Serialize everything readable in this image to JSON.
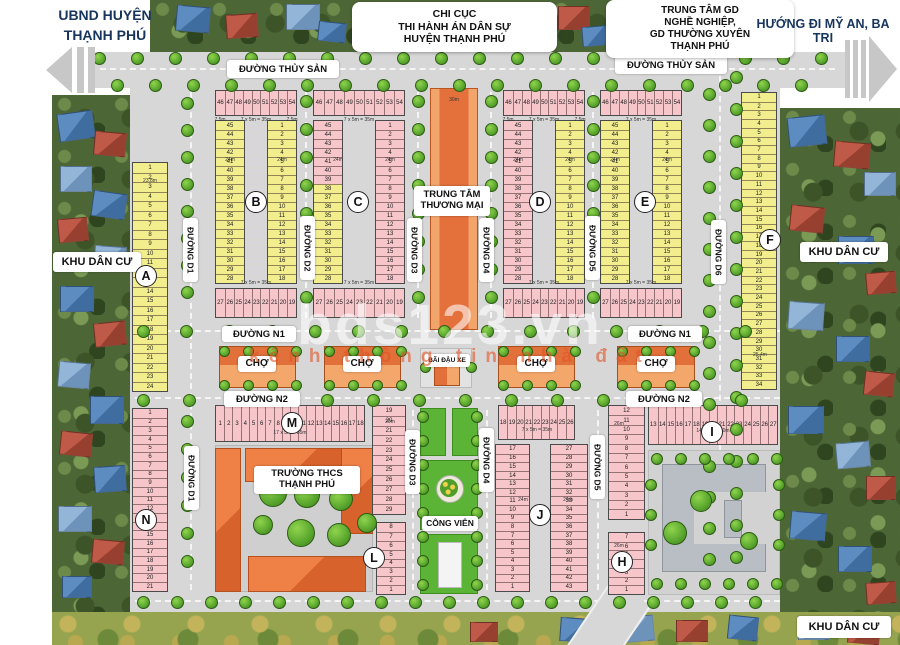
{
  "map_title_labels": {
    "top_left": "UBND HUYỆN\nTHẠNH PHÚ",
    "top_right": "HƯỚNG ĐI MỸ AN, BA TRI",
    "office_box_1": "CHI CỤC\nTHI HÀNH ÁN DÂN SỰ\nHUYỆN THẠNH PHÚ",
    "office_box_2": "TRUNG TÂM GD\nNGHỀ NGHIỆP,\nGD THƯỜNG XUYÊN\nTHẠNH PHÚ"
  },
  "watermark": {
    "line1": "bds123.vn",
    "line2": "kênh thông tin nhà đất"
  },
  "streets": [
    {
      "id": "thuysan_left",
      "text": "ĐƯỜNG THỦY SẢN"
    },
    {
      "id": "thuysan_right",
      "text": "ĐƯỜNG THỦY SẢN"
    },
    {
      "id": "n1_left",
      "text": "ĐƯỜNG N1"
    },
    {
      "id": "n1_right",
      "text": "ĐƯỜNG N1"
    },
    {
      "id": "n2_left",
      "text": "ĐƯỜNG N2"
    },
    {
      "id": "n2_right",
      "text": "ĐƯỜNG N2"
    },
    {
      "id": "d1_upper",
      "text": "ĐƯỜNG D1"
    },
    {
      "id": "d1_lower",
      "text": "ĐƯỜNG D1"
    },
    {
      "id": "d2",
      "text": "ĐƯỜNG D2"
    },
    {
      "id": "d3_upper",
      "text": "ĐƯỜNG D3"
    },
    {
      "id": "d3_lower",
      "text": "ĐƯỜNG D3"
    },
    {
      "id": "d4_upper",
      "text": "ĐƯỜNG D4"
    },
    {
      "id": "d4_lower",
      "text": "ĐƯỜNG D4"
    },
    {
      "id": "d5_upper",
      "text": "ĐƯỜNG D5"
    },
    {
      "id": "d5_lower",
      "text": "ĐƯỜNG D5"
    },
    {
      "id": "d6",
      "text": "ĐƯỜNG D6"
    }
  ],
  "landmarks": [
    {
      "id": "commercial_center",
      "text": "TRUNG TÂM\nTHƯƠNG MẠI"
    },
    {
      "id": "market_1",
      "text": "CHỢ"
    },
    {
      "id": "market_2",
      "text": "CHỢ"
    },
    {
      "id": "market_3",
      "text": "CHỢ"
    },
    {
      "id": "market_4",
      "text": "CHỢ"
    },
    {
      "id": "parking",
      "text": "BÃI ĐẬU XE"
    },
    {
      "id": "school",
      "text": "TRƯỜNG THCS\nTHẠNH PHÚ"
    },
    {
      "id": "park",
      "text": "CÔNG VIÊN"
    },
    {
      "id": "residential_left",
      "text": "KHU DÂN CƯ"
    },
    {
      "id": "residential_right",
      "text": "KHU DÂN CƯ"
    },
    {
      "id": "residential_bottom",
      "text": "KHU DÂN CƯ"
    }
  ],
  "blocks": [
    {
      "id": "A",
      "badge": "A",
      "segments": [
        {
          "key": "col",
          "color": "yellow",
          "numbers": [
            1,
            2,
            3,
            4,
            5,
            6,
            7,
            8,
            9,
            10,
            11,
            12,
            13,
            14,
            15,
            16,
            17,
            18,
            19,
            20,
            21,
            22,
            23,
            24
          ]
        }
      ]
    },
    {
      "id": "B",
      "badge": "B",
      "segments": [
        {
          "key": "top",
          "color": "pink",
          "numbers": [
            46,
            47,
            48,
            49,
            50,
            51,
            52,
            53,
            54
          ]
        },
        {
          "key": "left",
          "color": "yellow",
          "numbers": [
            45,
            44,
            43,
            42,
            41,
            40,
            39,
            38,
            37,
            36,
            35,
            34,
            33,
            32,
            31,
            30,
            29,
            28
          ]
        },
        {
          "key": "right",
          "color": "yellow",
          "numbers": [
            1,
            2,
            3,
            4,
            5,
            6,
            7,
            8,
            9,
            10,
            11,
            12,
            13,
            14,
            15,
            16,
            17,
            18
          ]
        },
        {
          "key": "bot",
          "color": "pink",
          "numbers": [
            27,
            26,
            25,
            24,
            23,
            22,
            21,
            20,
            19
          ]
        }
      ]
    },
    {
      "id": "C",
      "badge": "C",
      "segments": [
        {
          "key": "top",
          "color": "pink",
          "numbers": [
            46,
            47,
            48,
            49,
            50,
            51,
            52,
            53,
            54
          ]
        },
        {
          "key": "left",
          "colors": [
            "pink",
            "pink",
            "pink",
            "pink",
            "pink",
            "pink",
            "pink",
            "yellow",
            "yellow",
            "yellow",
            "yellow",
            "yellow",
            "yellow",
            "yellow",
            "yellow",
            "yellow",
            "yellow",
            "yellow"
          ],
          "numbers": [
            45,
            44,
            43,
            42,
            41,
            40,
            39,
            38,
            37,
            36,
            35,
            34,
            33,
            32,
            31,
            30,
            29,
            28
          ]
        },
        {
          "key": "right",
          "color": "pink",
          "numbers": [
            1,
            2,
            3,
            4,
            5,
            6,
            7,
            8,
            9,
            10,
            11,
            12,
            13,
            14,
            15,
            16,
            17,
            18
          ]
        },
        {
          "key": "bot",
          "color": "pink",
          "numbers": [
            27,
            26,
            25,
            24,
            23,
            22,
            21,
            20,
            19
          ]
        }
      ]
    },
    {
      "id": "D",
      "badge": "D",
      "segments": [
        {
          "key": "top",
          "color": "pink",
          "numbers": [
            46,
            47,
            48,
            49,
            50,
            51,
            52,
            53,
            54
          ]
        },
        {
          "key": "left",
          "color": "pink",
          "numbers": [
            45,
            44,
            43,
            42,
            41,
            40,
            39,
            38,
            37,
            36,
            35,
            34,
            33,
            32,
            31,
            30,
            29,
            28
          ]
        },
        {
          "key": "right",
          "color": "yellow",
          "numbers": [
            1,
            2,
            3,
            4,
            5,
            6,
            7,
            8,
            9,
            10,
            11,
            12,
            13,
            14,
            15,
            16,
            17,
            18
          ]
        },
        {
          "key": "bot",
          "color": "pink",
          "numbers": [
            27,
            26,
            25,
            24,
            23,
            22,
            21,
            20,
            19
          ]
        }
      ]
    },
    {
      "id": "E",
      "badge": "E",
      "segments": [
        {
          "key": "top",
          "color": "pink",
          "numbers": [
            46,
            47,
            48,
            49,
            50,
            51,
            52,
            53,
            54
          ]
        },
        {
          "key": "left",
          "color": "yellow",
          "numbers": [
            45,
            44,
            43,
            42,
            41,
            40,
            39,
            38,
            37,
            36,
            35,
            34,
            33,
            32,
            31,
            30,
            29,
            28
          ]
        },
        {
          "key": "right",
          "color": "yellow",
          "numbers": [
            1,
            2,
            3,
            4,
            5,
            6,
            7,
            8,
            9,
            10,
            11,
            12,
            13,
            14,
            15,
            16,
            17,
            18
          ]
        },
        {
          "key": "bot",
          "color": "pink",
          "numbers": [
            27,
            26,
            25,
            24,
            23,
            22,
            21,
            20,
            19
          ]
        }
      ]
    },
    {
      "id": "F",
      "badge": "F",
      "segments": [
        {
          "key": "col",
          "color": "yellow",
          "numbers": [
            1,
            2,
            3,
            4,
            5,
            6,
            7,
            8,
            9,
            10,
            11,
            12,
            13,
            14,
            15,
            16,
            17,
            18,
            19,
            20,
            21,
            22,
            23,
            24,
            25,
            26,
            27,
            28,
            29,
            30,
            31,
            32,
            33,
            34
          ]
        }
      ]
    },
    {
      "id": "M",
      "badge": "M",
      "segments": [
        {
          "key": "top",
          "color": "pink",
          "numbers": [
            1,
            2,
            3,
            4,
            5,
            6,
            7,
            8,
            9,
            10,
            11,
            12,
            13,
            14,
            15,
            16,
            17,
            18
          ]
        },
        {
          "key": "right",
          "color": "pink",
          "numbers": [
            19,
            20,
            21,
            22,
            23,
            24,
            25,
            26,
            27,
            28,
            29
          ]
        }
      ]
    },
    {
      "id": "N",
      "badge": "N",
      "segments": [
        {
          "key": "col",
          "color": "pink",
          "numbers": [
            1,
            2,
            3,
            4,
            5,
            6,
            7,
            8,
            9,
            10,
            11,
            12,
            13,
            14,
            15,
            16,
            17,
            18,
            19,
            20,
            21
          ]
        }
      ]
    },
    {
      "id": "L",
      "badge": "L",
      "segments": [
        {
          "key": "col",
          "color": "pink",
          "numbers": [
            8,
            7,
            6,
            5,
            4,
            3,
            2,
            1
          ]
        }
      ]
    },
    {
      "id": "J",
      "badge": "J",
      "segments": [
        {
          "key": "top",
          "color": "pink",
          "numbers": [
            18,
            19,
            20,
            21,
            22,
            23,
            24,
            25,
            26
          ]
        },
        {
          "key": "left",
          "color": "pink",
          "numbers": [
            17,
            16,
            15,
            14,
            13,
            12,
            11,
            10,
            9,
            8,
            7,
            6,
            5,
            4,
            3,
            2,
            1
          ]
        },
        {
          "key": "right",
          "color": "pink",
          "numbers": [
            27,
            28,
            29,
            30,
            31,
            32,
            33,
            34,
            35,
            36,
            37,
            38,
            39,
            40,
            41,
            42,
            43
          ]
        }
      ]
    },
    {
      "id": "I",
      "badge": "I",
      "segments": [
        {
          "key": "left",
          "color": "pink",
          "numbers": [
            12,
            11,
            10,
            9,
            8,
            7,
            6,
            5,
            4,
            3,
            2,
            1
          ]
        },
        {
          "key": "top",
          "color": "pink",
          "numbers": [
            13,
            14,
            15,
            16,
            17,
            18,
            19,
            20,
            21,
            22,
            23,
            24,
            25,
            26,
            27
          ]
        }
      ]
    },
    {
      "id": "H",
      "badge": "H",
      "segments": [
        {
          "key": "col",
          "color": "pink",
          "numbers": [
            7,
            6,
            5,
            4,
            3,
            2,
            1
          ]
        }
      ]
    }
  ],
  "dimensions": [
    {
      "text": "7 x 5m = 35m",
      "x": 256,
      "y": 120
    },
    {
      "text": "7 x 5m = 35m",
      "x": 359,
      "y": 120
    },
    {
      "text": "7 x 5m = 35m",
      "x": 544,
      "y": 120
    },
    {
      "text": "7 x 5m = 35m",
      "x": 641,
      "y": 120
    },
    {
      "text": "7 x 5m = 35m",
      "x": 256,
      "y": 283
    },
    {
      "text": "7 x 5m = 35m",
      "x": 359,
      "y": 283
    },
    {
      "text": "7 x 5m = 35m",
      "x": 544,
      "y": 283
    },
    {
      "text": "7 x 5m = 35m",
      "x": 641,
      "y": 283
    },
    {
      "text": "7.5m",
      "x": 220,
      "y": 120
    },
    {
      "text": "7.5m",
      "x": 292,
      "y": 120
    },
    {
      "text": "7.5m",
      "x": 508,
      "y": 120
    },
    {
      "text": "7.5m",
      "x": 580,
      "y": 120
    },
    {
      "text": "24m",
      "x": 230,
      "y": 160
    },
    {
      "text": "24m",
      "x": 282,
      "y": 160
    },
    {
      "text": "24m",
      "x": 338,
      "y": 160
    },
    {
      "text": "24m",
      "x": 390,
      "y": 160
    },
    {
      "text": "24m",
      "x": 518,
      "y": 160
    },
    {
      "text": "24m",
      "x": 570,
      "y": 160
    },
    {
      "text": "24m",
      "x": 615,
      "y": 160
    },
    {
      "text": "24m",
      "x": 667,
      "y": 160
    },
    {
      "text": "30m",
      "x": 454,
      "y": 100
    },
    {
      "text": "23.8m",
      "x": 150,
      "y": 181
    },
    {
      "text": "25.4m",
      "x": 760,
      "y": 355
    },
    {
      "text": "17 x 5m = 85m",
      "x": 290,
      "y": 433
    },
    {
      "text": "14 x 5m = 70m",
      "x": 713,
      "y": 431
    },
    {
      "text": "7 x 5m = 35m",
      "x": 537,
      "y": 430
    },
    {
      "text": "26m",
      "x": 619,
      "y": 424
    },
    {
      "text": "26m",
      "x": 619,
      "y": 546
    },
    {
      "text": "24m",
      "x": 523,
      "y": 500
    },
    {
      "text": "24m",
      "x": 568,
      "y": 500
    },
    {
      "text": "20m",
      "x": 390,
      "y": 422
    }
  ]
}
